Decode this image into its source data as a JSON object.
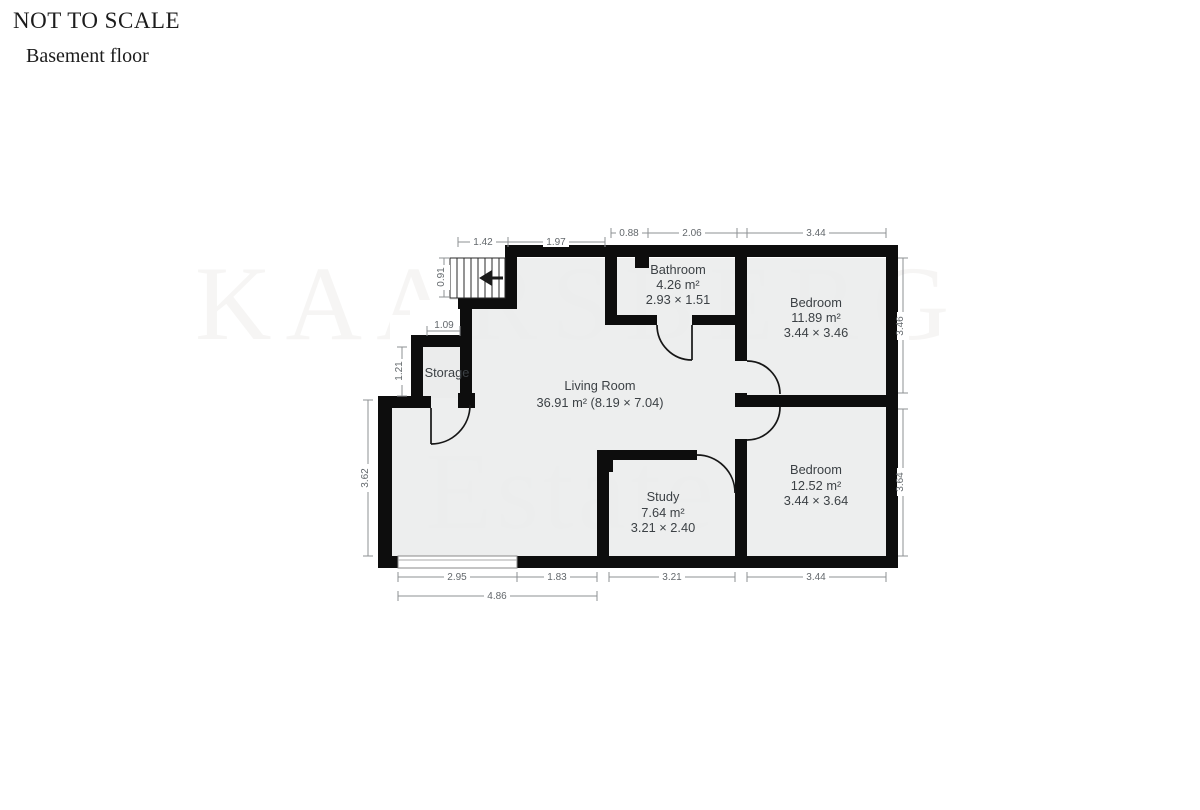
{
  "header": {
    "scale_note": "NOT TO SCALE",
    "floor_label": "Basement floor"
  },
  "watermark": {
    "line1": "KAARSBERG",
    "line2": "Estate"
  },
  "rooms": {
    "bathroom": {
      "name": "Bathroom",
      "area": "4.26 m²",
      "dims": "2.93 × 1.51"
    },
    "bedroom1": {
      "name": "Bedroom",
      "area": "11.89 m²",
      "dims": "3.44 × 3.46"
    },
    "living": {
      "name": "Living Room",
      "area": "36.91 m² (8.19 × 7.04)"
    },
    "storage": {
      "name": "Storage"
    },
    "study": {
      "name": "Study",
      "area": "7.64 m²",
      "dims": "3.21 × 2.40"
    },
    "bedroom2": {
      "name": "Bedroom",
      "area": "12.52 m²",
      "dims": "3.44 × 3.64"
    }
  },
  "dimensions": {
    "top": {
      "stairs_width": "1.42",
      "hall": "1.97",
      "entry": "0.88",
      "bathroom": "2.06",
      "bedroom1": "3.44"
    },
    "left": {
      "stairs_depth": "0.91",
      "recess": "1.09",
      "storage": "1.21",
      "living_height": "3.62"
    },
    "right": {
      "bedroom1_height": "3.46",
      "bedroom2_height": "3.64"
    },
    "bottom": {
      "window": "2.95",
      "living": "1.83",
      "study": "3.21",
      "bedroom2": "3.44",
      "total": "4.86"
    }
  },
  "colors": {
    "wall": "#0d0d0d",
    "room_fill": "#ebecec",
    "dimension": "#8d9093",
    "label_text": "#3c4145"
  }
}
